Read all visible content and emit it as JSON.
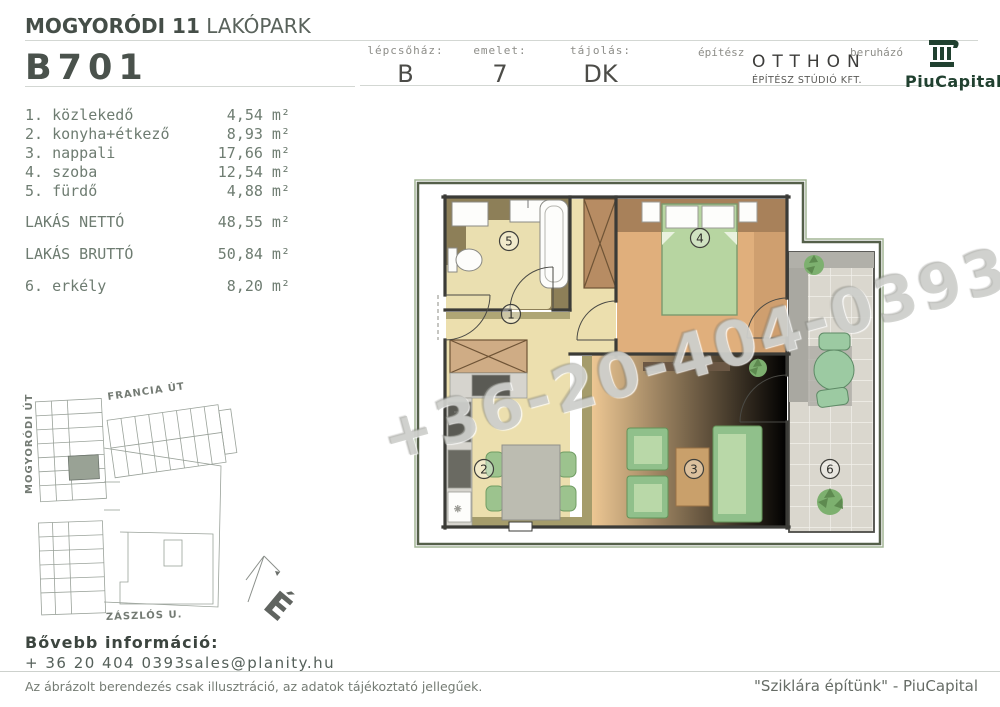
{
  "header": {
    "project_bold": "MOGYORÓDI 11",
    "project_light": "LAKÓPARK",
    "unit_id": "B701",
    "info_cells": [
      {
        "label": "lépcsőház:",
        "value": "B"
      },
      {
        "label": "emelet:",
        "value": "7"
      },
      {
        "label": "tájolás:",
        "value": "DK"
      }
    ],
    "architect_label": "építész",
    "architect_name": "OTTHON",
    "architect_sub": "ÉPÍTÉSZ STÚDIÓ KFT.",
    "developer_label": "beruházó",
    "developer_name": "PiuCapital"
  },
  "room_list": {
    "items": [
      {
        "label": "1. közlekedő",
        "area": "4,54 m²"
      },
      {
        "label": "2. konyha+étkező",
        "area": "8,93 m²"
      },
      {
        "label": "3. nappali",
        "area": "17,66 m²"
      },
      {
        "label": "4. szoba",
        "area": "12,54 m²"
      },
      {
        "label": "5. fürdő",
        "area": "4,88 m²"
      }
    ],
    "totals": [
      {
        "label": "LAKÁS NETTÓ",
        "area": "48,55 m²"
      },
      {
        "label": "LAKÁS BRUTTÓ",
        "area": "50,84 m²"
      }
    ],
    "extra": {
      "label": "6. erkély",
      "area": "8,20 m²"
    }
  },
  "site_plan": {
    "streets": [
      "FRANCIA ÚT",
      "MOGYORÓDI ÚT",
      "ZÁSZLÓS U."
    ],
    "north_label": "É"
  },
  "floor_plan": {
    "room_numbers": [
      "1",
      "2",
      "3",
      "4",
      "5",
      "6"
    ]
  },
  "watermark": "+36-20-404-039306-70-442-2",
  "footer": {
    "info_title": "Bővebb információ:",
    "phone": "+ 36 20 404 0393",
    "email": "sales@planity.hu",
    "disclaimer": "Az ábrázolt berendezés csak illusztráció, az adatok tájékoztató jellegűek.",
    "slogan": "\"Sziklára építünk\" - PiuCapital"
  },
  "colors": {
    "brand_green": "#214130",
    "heading_gray_green": "#4a524c",
    "floor_beige": "#eadfb0",
    "floor_wood": "#e0af7c",
    "floor_olive": "#8d7f58",
    "furniture_green": "#9cc38e",
    "balcony_gray": "#dad7ce"
  }
}
